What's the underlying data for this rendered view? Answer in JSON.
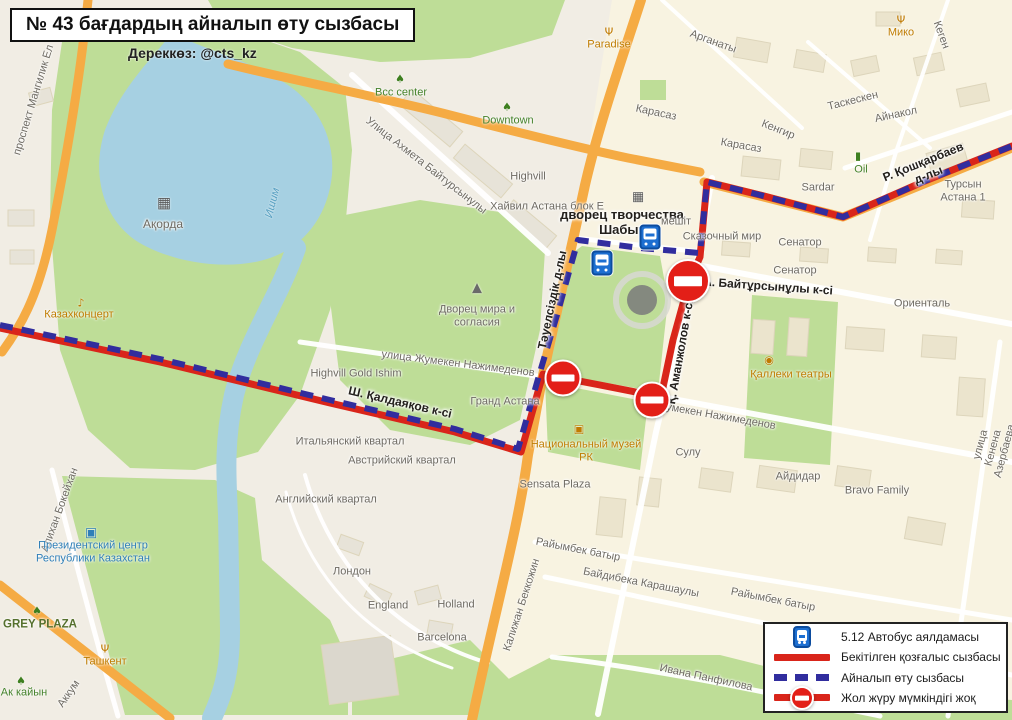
{
  "title": {
    "heading": "№ 43 бағдардың айналып өту сызбасы",
    "source": "Дереккөз: @cts_kz"
  },
  "legend": {
    "items": [
      {
        "symbol": "bus-stop",
        "label": "5.12 Автобус аялдамасы"
      },
      {
        "symbol": "solid-red-line",
        "label": "Бекітілген қозғалыс сызбасы",
        "color": "#d9251a"
      },
      {
        "symbol": "dashed-blue-line",
        "label": "Айналып өту сызбасы",
        "color": "#312d9e"
      },
      {
        "symbol": "road-closed",
        "label": "Жол жүру мүмкіндігі жоқ",
        "color": "#e31f18"
      }
    ]
  },
  "colors": {
    "approved_route_red": "#d9251a",
    "detour_blue": "#312d9e",
    "closed_sign_red": "#e31f18",
    "water": "#a6d0e2",
    "park_green": "#bedd97",
    "road_orange": "#f5ab44",
    "residential_yellow": "#f8f3e1",
    "base_cream": "#f1ede4"
  },
  "map": {
    "routes": {
      "approved": "0,328 160,362 330,403 455,432 521,452 543,374 600,385 661,397 673,340 689,282 700,257 707,182 760,195 843,217 925,181 1012,146",
      "detour": "0,325 160,359 330,400 455,429 518,449 540,372 557,315 569,272 578,240 640,248 700,253 707,182 760,195 843,217 925,181 1012,146"
    },
    "bus_stops": [
      {
        "x": 650,
        "y": 237
      },
      {
        "x": 602,
        "y": 263
      }
    ],
    "road_closed": [
      {
        "x": 688,
        "y": 281,
        "d": 40
      },
      {
        "x": 563,
        "y": 378,
        "d": 33
      },
      {
        "x": 652,
        "y": 400,
        "d": 33
      }
    ],
    "labels": [
      {
        "text": "проспект Мангилик Ел",
        "x": 34,
        "y": 100,
        "rot": -73,
        "cls": "st"
      },
      {
        "text": "Ақорда",
        "x": 163,
        "y": 225,
        "cls": "st",
        "fs": 12
      },
      {
        "text": "Ишим",
        "x": 273,
        "y": 203,
        "rot": -76,
        "cls": "wt"
      },
      {
        "text": "Казахконцерт",
        "x": 79,
        "y": 315,
        "cls": "po"
      },
      {
        "text": "Дворец мира и\nсогласия",
        "x": 477,
        "y": 316,
        "cls": "st"
      },
      {
        "text": "Bcc center",
        "x": 401,
        "y": 93,
        "cls": "pg"
      },
      {
        "text": "Downtown",
        "x": 508,
        "y": 121,
        "cls": "pg"
      },
      {
        "text": "Улица Ахмета Байтурсынулы",
        "x": 426,
        "y": 166,
        "rot": 38,
        "cls": "st"
      },
      {
        "text": "Highvill",
        "x": 528,
        "y": 177,
        "cls": "st"
      },
      {
        "text": "Хайвил Астана блок Е",
        "x": 547,
        "y": 207,
        "cls": "st"
      },
      {
        "text": "дворец творчества\nШабыт",
        "x": 622,
        "y": 223,
        "cls": "stb",
        "fs": 13
      },
      {
        "text": "мешіт",
        "x": 676,
        "y": 222,
        "cls": "st"
      },
      {
        "text": "Сказочный мир",
        "x": 722,
        "y": 237,
        "cls": "st"
      },
      {
        "text": "Сенатор",
        "x": 800,
        "y": 243,
        "cls": "st"
      },
      {
        "text": "Сенатор",
        "x": 795,
        "y": 271,
        "cls": "st"
      },
      {
        "text": "Ориенталь",
        "x": 922,
        "y": 304,
        "cls": "st"
      },
      {
        "text": "Paradise",
        "x": 609,
        "y": 45,
        "cls": "po"
      },
      {
        "text": "Мико",
        "x": 901,
        "y": 33,
        "cls": "po"
      },
      {
        "text": "Арганаты",
        "x": 713,
        "y": 42,
        "rot": 20,
        "cls": "st"
      },
      {
        "text": "Карасаз",
        "x": 656,
        "y": 113,
        "rot": 12,
        "cls": "st"
      },
      {
        "text": "Карасаз",
        "x": 741,
        "y": 146,
        "rot": 10,
        "cls": "st"
      },
      {
        "text": "Кенгир",
        "x": 778,
        "y": 130,
        "rot": 22,
        "cls": "st"
      },
      {
        "text": "Кеген",
        "x": 941,
        "y": 35,
        "rot": 70,
        "cls": "st"
      },
      {
        "text": "Таскескен",
        "x": 853,
        "y": 101,
        "rot": -14,
        "cls": "st"
      },
      {
        "text": "Айнакол",
        "x": 896,
        "y": 115,
        "rot": -12,
        "cls": "st"
      },
      {
        "text": "Sardar",
        "x": 818,
        "y": 188,
        "cls": "st"
      },
      {
        "text": "Турсын Астана 1",
        "x": 963,
        "y": 191,
        "cls": "st"
      },
      {
        "text": "Oil",
        "x": 861,
        "y": 170,
        "cls": "pg"
      },
      {
        "text": "Р. Қошқарбаев д-лы",
        "x": 926,
        "y": 169,
        "rot": -22,
        "cls": "stb"
      },
      {
        "text": "А. Байтұрсынұлы к-сі",
        "x": 768,
        "y": 287,
        "rot": 4,
        "cls": "stb"
      },
      {
        "text": "Тәуелсіздік д-лы",
        "x": 553,
        "y": 300,
        "rot": -78,
        "cls": "stb"
      },
      {
        "text": "Қ. Аманжолов к-сі",
        "x": 681,
        "y": 352,
        "rot": -80,
        "cls": "stb"
      },
      {
        "text": "Қаллеки театры",
        "x": 791,
        "y": 375,
        "cls": "po"
      },
      {
        "text": "улица Жумекен Нажимеденов",
        "x": 458,
        "y": 364,
        "rot": 7,
        "cls": "st"
      },
      {
        "text": "Highvill Gold Ishim",
        "x": 356,
        "y": 374,
        "cls": "st"
      },
      {
        "text": "Ш. Қалдаяқов к-сі",
        "x": 400,
        "y": 403,
        "rot": 13,
        "cls": "stb"
      },
      {
        "text": "Гранд Астана",
        "x": 505,
        "y": 402,
        "cls": "st"
      },
      {
        "text": "Жумекен Нажимеденов",
        "x": 716,
        "y": 416,
        "rot": 10,
        "cls": "st"
      },
      {
        "text": "Итальянский квартал",
        "x": 350,
        "y": 442,
        "cls": "st"
      },
      {
        "text": "Австрийский квартал",
        "x": 402,
        "y": 461,
        "cls": "st"
      },
      {
        "text": "Национальный музей\nРК",
        "x": 586,
        "y": 451,
        "cls": "po"
      },
      {
        "text": "Сулу",
        "x": 688,
        "y": 453,
        "cls": "st"
      },
      {
        "text": "Айдидар",
        "x": 798,
        "y": 477,
        "cls": "st"
      },
      {
        "text": "Bravo Family",
        "x": 877,
        "y": 491,
        "cls": "st"
      },
      {
        "text": "улица Кенена Азербаева",
        "x": 993,
        "y": 448,
        "rot": -75,
        "cls": "st"
      },
      {
        "text": "Английский квартал",
        "x": 326,
        "y": 500,
        "cls": "st"
      },
      {
        "text": "Sensata Plaza",
        "x": 555,
        "y": 485,
        "cls": "st"
      },
      {
        "text": "Лондон",
        "x": 352,
        "y": 572,
        "cls": "st"
      },
      {
        "text": "England",
        "x": 388,
        "y": 606,
        "cls": "st"
      },
      {
        "text": "Holland",
        "x": 456,
        "y": 605,
        "cls": "st"
      },
      {
        "text": "Barcelona",
        "x": 442,
        "y": 638,
        "cls": "st"
      },
      {
        "text": "Калижан Беккожин",
        "x": 522,
        "y": 605,
        "rot": -72,
        "cls": "st"
      },
      {
        "text": "Райымбек батыр",
        "x": 578,
        "y": 550,
        "rot": 11,
        "cls": "st"
      },
      {
        "text": "Байдибека Карашаулы",
        "x": 641,
        "y": 583,
        "rot": 11,
        "cls": "st"
      },
      {
        "text": "Райымбек батыр",
        "x": 773,
        "y": 600,
        "rot": 11,
        "cls": "st"
      },
      {
        "text": "Ивана Панфилова",
        "x": 706,
        "y": 678,
        "rot": 12,
        "cls": "st"
      },
      {
        "text": "Алихан Бокейхан",
        "x": 60,
        "y": 510,
        "rot": -70,
        "cls": "st"
      },
      {
        "text": "Президентский центр\nРеспублики Казахстан",
        "x": 93,
        "y": 552,
        "cls": "pb"
      },
      {
        "text": "GREY PLAZA",
        "x": 40,
        "y": 625,
        "cls": "plaza"
      },
      {
        "text": "Ташкент",
        "x": 105,
        "y": 662,
        "cls": "po"
      },
      {
        "text": "Ак кайын",
        "x": 24,
        "y": 693,
        "cls": "pg"
      },
      {
        "text": "Аккум",
        "x": 69,
        "y": 694,
        "rot": -55,
        "cls": "st"
      }
    ],
    "poi_icons": [
      {
        "name": "restaurant-icon",
        "char": "Ψ",
        "color": "#c07a00",
        "x": 609,
        "y": 32
      },
      {
        "name": "restaurant-icon",
        "char": "Ψ",
        "color": "#c07a00",
        "x": 901,
        "y": 20
      },
      {
        "name": "restaurant-icon",
        "char": "Ψ",
        "color": "#c07a00",
        "x": 105,
        "y": 649
      },
      {
        "name": "music-icon",
        "char": "♪",
        "color": "#c07a00",
        "x": 81,
        "y": 303
      },
      {
        "name": "theater-icon",
        "char": "◉",
        "color": "#c07a00",
        "x": 769,
        "y": 360
      },
      {
        "name": "museum-icon",
        "char": "▣",
        "color": "#c07a00",
        "x": 579,
        "y": 429
      },
      {
        "name": "fuel-icon",
        "char": "▮",
        "color": "#3e7f1f",
        "x": 858,
        "y": 156
      },
      {
        "name": "tree-icon",
        "char": "♠",
        "color": "#3e7f1f",
        "x": 21,
        "y": 681
      },
      {
        "name": "tree-icon",
        "char": "♠",
        "color": "#3e7f1f",
        "x": 400,
        "y": 79
      },
      {
        "name": "tree-icon",
        "char": "♠",
        "color": "#3e7f1f",
        "x": 507,
        "y": 107
      },
      {
        "name": "tree-icon",
        "char": "♠",
        "color": "#3e7f1f",
        "x": 37,
        "y": 611
      },
      {
        "name": "government-icon",
        "char": "▦",
        "color": "#5a5a5a",
        "x": 164,
        "y": 203,
        "fs": 15
      },
      {
        "name": "pyramid-icon",
        "char": "▲",
        "color": "#6a6a6a",
        "x": 477,
        "y": 288,
        "fs": 13
      },
      {
        "name": "culture-palace-icon",
        "char": "▦",
        "color": "#5a5a5a",
        "x": 638,
        "y": 197,
        "fs": 13
      },
      {
        "name": "president-center-icon",
        "char": "▣",
        "color": "#2f7fb8",
        "x": 91,
        "y": 533,
        "fs": 13
      }
    ]
  }
}
